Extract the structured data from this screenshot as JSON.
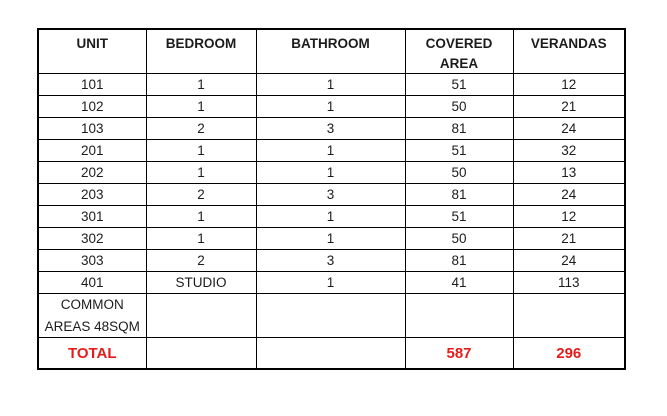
{
  "table": {
    "headers": [
      "UNIT",
      "BEDROOM",
      "BATHROOM",
      "COVERED AREA",
      "VERANDAS"
    ],
    "rows": [
      [
        "101",
        "1",
        "1",
        "51",
        "12"
      ],
      [
        "102",
        "1",
        "1",
        "50",
        "21"
      ],
      [
        "103",
        "2",
        "3",
        "81",
        "24"
      ],
      [
        "201",
        "1",
        "1",
        "51",
        "32"
      ],
      [
        "202",
        "1",
        "1",
        "50",
        "13"
      ],
      [
        "203",
        "2",
        "3",
        "81",
        "24"
      ],
      [
        "301",
        "1",
        "1",
        "51",
        "12"
      ],
      [
        "302",
        "1",
        "1",
        "50",
        "21"
      ],
      [
        "303",
        "2",
        "3",
        "81",
        "24"
      ],
      [
        "401",
        "STUDIO",
        "1",
        "41",
        "113"
      ]
    ],
    "common_areas_label": "COMMON AREAS 48SQM",
    "total": {
      "label": "TOTAL",
      "covered_area": "587",
      "verandas": "296"
    },
    "colors": {
      "total_red": "#e31c1c",
      "border": "#000000",
      "text": "#1c1c1c"
    }
  }
}
